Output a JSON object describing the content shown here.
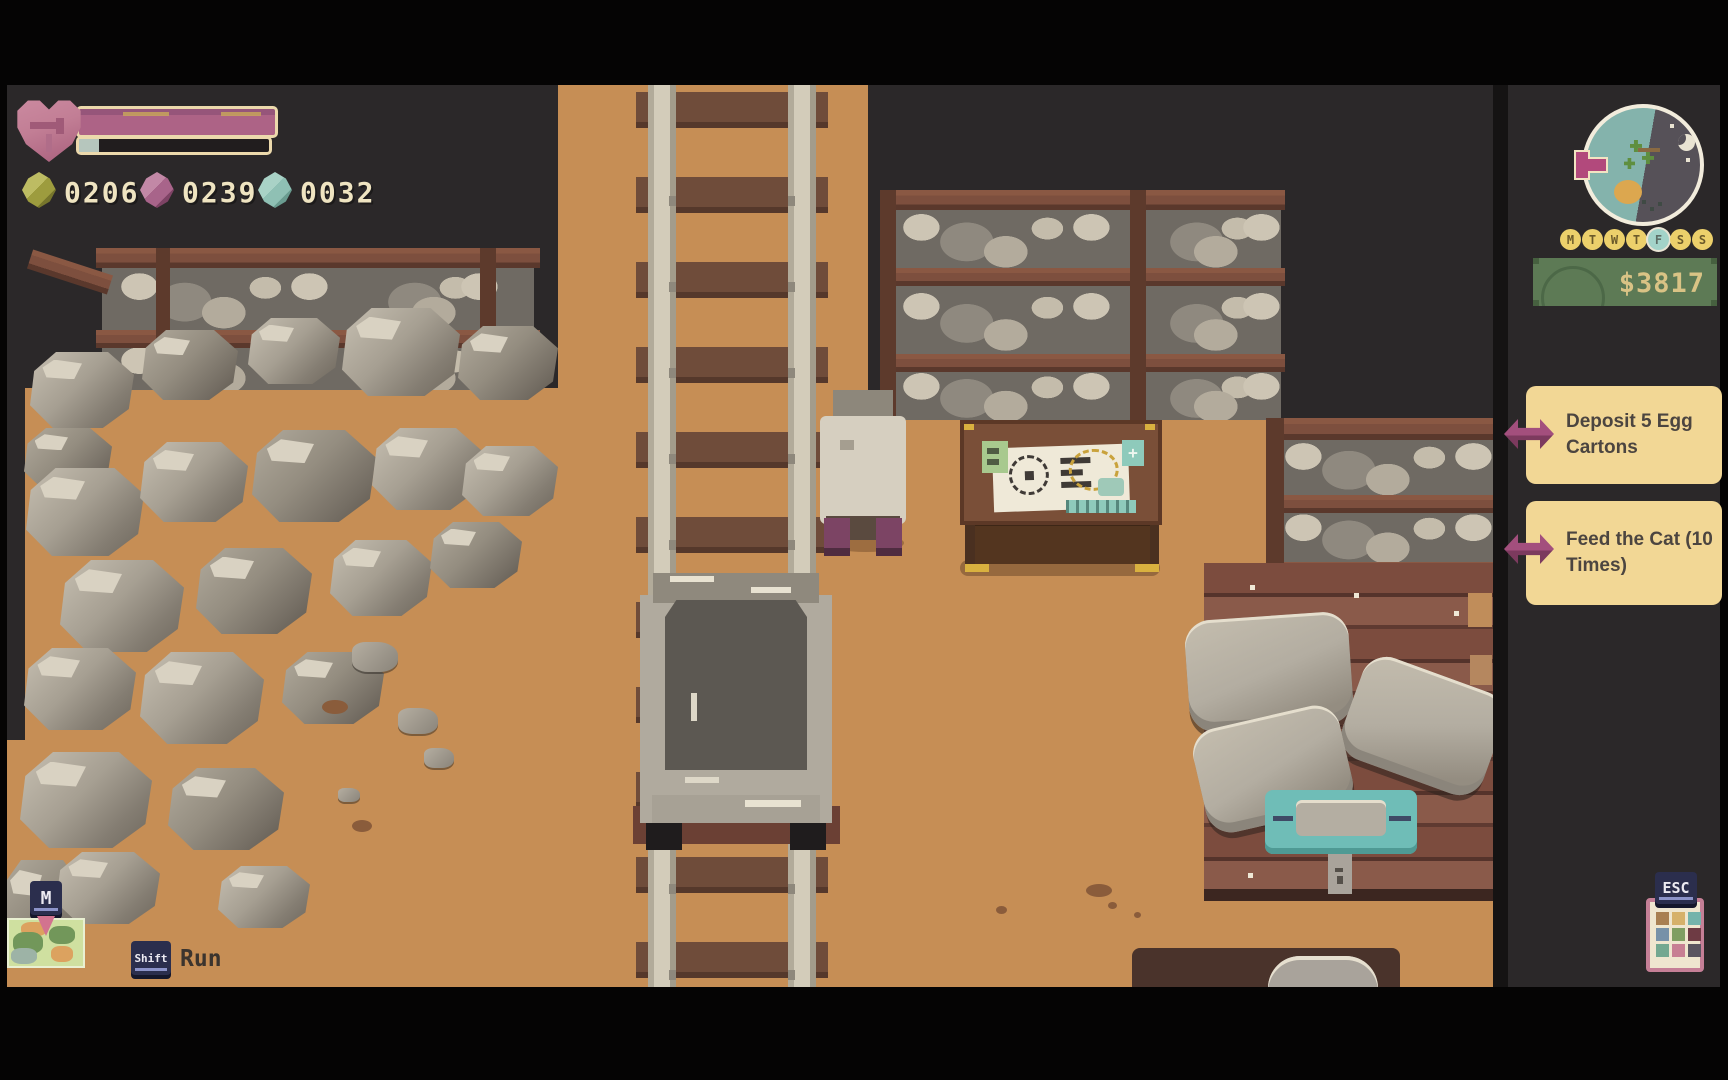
{
  "hud": {
    "health": {
      "icon": "heart-icon",
      "health_percent": 100,
      "stamina_percent": 10
    },
    "currencies": [
      {
        "name": "olive-gem",
        "value": "0206",
        "color": "#9d9c3e"
      },
      {
        "name": "pink-gem",
        "value": "0239",
        "color": "#a8648a"
      },
      {
        "name": "teal-gem",
        "value": "0032",
        "color": "#8fc0b4"
      }
    ]
  },
  "minimap": {
    "day_side_color": "#84b3ac",
    "night_side_color": "#565158",
    "features": [
      "trees",
      "pond",
      "flag-marker",
      "moon",
      "stars"
    ]
  },
  "calendar": {
    "days": [
      {
        "label": "M",
        "active": false
      },
      {
        "label": "T",
        "active": false
      },
      {
        "label": "W",
        "active": false
      },
      {
        "label": "T",
        "active": false
      },
      {
        "label": "F",
        "active": true
      },
      {
        "label": "S",
        "active": false
      },
      {
        "label": "S",
        "active": false
      }
    ],
    "active_day": "F"
  },
  "money": {
    "amount": "$3817",
    "box_color": "#5d7a55",
    "text_color": "#d9c385"
  },
  "quests": [
    {
      "label": "Deposit 5 Egg Cartons"
    },
    {
      "label": "Feed the Cat (10 Times)"
    }
  ],
  "controls": {
    "map_key": "M",
    "run_key": "Shift",
    "run_label": "Run",
    "menu_key": "ESC"
  },
  "inventory_icon_palette": [
    "#a87f52",
    "#d6b16a",
    "#74b3ab",
    "#7791a8",
    "#7f9e62",
    "#6e3b44",
    "#74a890",
    "#c77f93",
    "#5a5560"
  ],
  "scene_colors": {
    "cave": "#2b2829",
    "dirt": "#c68e55",
    "wood": "#7d4f3e",
    "stone": "#a69f92"
  }
}
